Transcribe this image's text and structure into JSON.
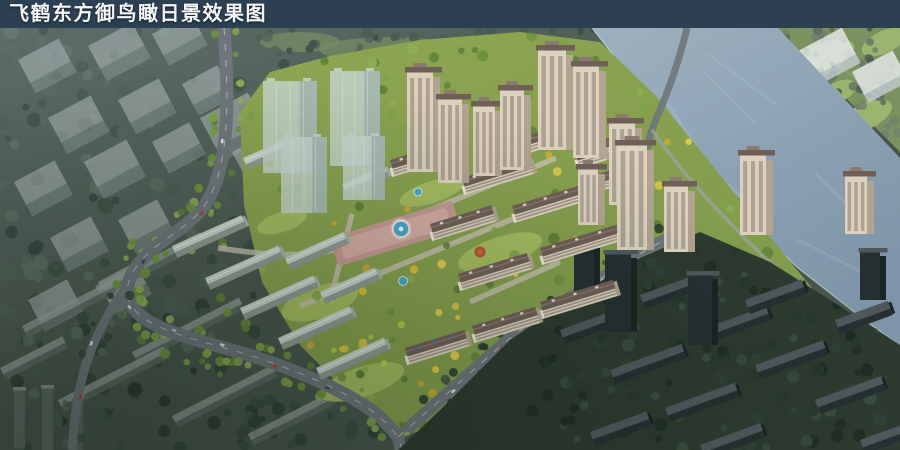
{
  "header": {
    "title": "飞鹤东方御鸟瞰日景效果图"
  },
  "colors": {
    "title_bar": "#2c4052",
    "title_text": "#f4f6f8",
    "context_base": "#47564c",
    "haze": "#8796a0",
    "forest_left": [
      "#2c3b31",
      "#35463a",
      "#405245",
      "#4b5d4e",
      "#56685a"
    ],
    "forest_top": [
      "#2e3f34",
      "#394c3e",
      "#445848"
    ],
    "ghost_top": "#b9c3bf",
    "ghost_front": "#828f8b",
    "ghost_slab_top": "#9aa5a0",
    "ghost_slab_front": "#626d68",
    "glass_tower": "#c4d4cd",
    "glass_tower_shade": "#9db1ab",
    "white_block": "#e6eaec",
    "white_block_front": "#c2cbd0",
    "river": "#7e95a9",
    "river_light": "#9db0bf",
    "river_sparkle": "#dfe9ee",
    "bank_trees": [
      "#374f41",
      "#42594a",
      "#4d6453",
      "#586e5c"
    ],
    "far_bank_base": "#7b9160",
    "far_bank_lawn": "#9cb56e",
    "far_bank_trees": [
      "#4e5e52",
      "#5a6a5c",
      "#667668",
      "#72816f"
    ],
    "site_base": "#7f9a4b",
    "site_base2": "#8ea653",
    "site_lawn": "#a9bf63",
    "clearing": "#6f8b52",
    "site_trees": [
      "#5f8038",
      "#6f923f",
      "#7fa24a",
      "#8fae54"
    ],
    "site_trees_yellow": [
      "#d8bf3b",
      "#e2cc49",
      "#c7ad35",
      "#b5cf49"
    ],
    "road": "#6e767b",
    "road_line": "#eceada",
    "inner_road": "#c7c0b0",
    "promenade": "#9aa39e",
    "wall": "#ded2bf",
    "wall_bright": "#efe6d6",
    "wall_shade": "#b3a391",
    "window": "#5c564e",
    "roof": "#6f5f57",
    "roof_light": "#8a7a70",
    "roof_vent": "#e3e0d8",
    "solar_panel": "#3d6ea8",
    "roof_pale": "#c6d2c9",
    "roof_pale_ridge": "#dde6df",
    "pale_front": "#8e9a93",
    "pale_end": "#a7b2ab",
    "dark_base": "#2c3a2f",
    "dark_trees": [
      "#1f2d24",
      "#28382c",
      "#314234",
      "#3a4c3d"
    ],
    "dark_roof": "#4e585c",
    "dark_front": "#262f31",
    "dark_side": "#1c2325",
    "thin_tower": "#5d6a66",
    "thin_tower_top": "#8a958f",
    "plaza": "#c59a92",
    "plaza_ring": "#dcbcb2",
    "pool": "#45aacd",
    "pool_rim": "#e8f4f8",
    "canopy": "#b0542f",
    "canopy_light": "#c96a3f",
    "car_colors": [
      "#e9e9e6",
      "#c23a2e",
      "#394450",
      "#d7dadb",
      "#b9bec2"
    ]
  }
}
